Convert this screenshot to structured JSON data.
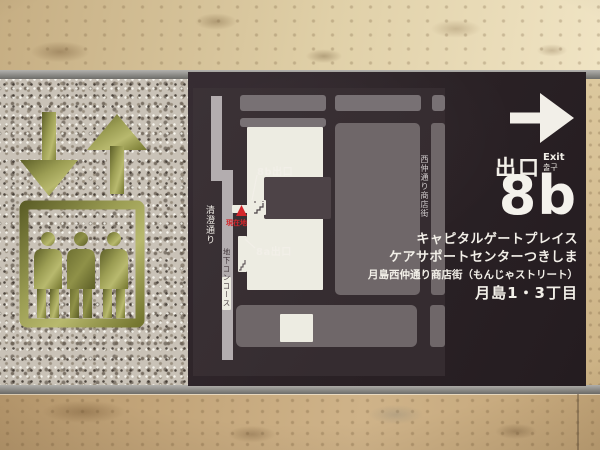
{
  "sign": {
    "exit_word_jp": "出口",
    "exit_word_en": "Exit",
    "exit_word_ko": "출구",
    "exit_number": "8b",
    "destinations": [
      "キャピタルゲートプレイス",
      "ケアサポートセンターつきしま",
      "月島西仲通り商店街（もんじゃストリート）",
      "月島1・3丁目"
    ]
  },
  "map": {
    "exit_8b_label": "8b出口",
    "exit_8a_label": "8a出口",
    "you_are_here_label": "現在地",
    "kiyosumi_street_label": "清澄通り",
    "underground_concourse_label": "地下コンコース",
    "nishinaka_street_label": "西仲通り商店街"
  },
  "icons": {
    "direction": "right-arrow-icon",
    "elevator": "elevator-people-icon with down-arrow-icon and up-arrow-icon",
    "exit_markers": "stairs-icon at 8a and 8b",
    "current_position": "you-are-here-triangle-icon"
  },
  "colors": {
    "sign_background": "#2b2226",
    "map_background": "#372e32",
    "city_block_gray": "#6f6769",
    "concourse_gray": "#b3adaf",
    "station_block_white": "#edece2",
    "text_white": "#f2efe8",
    "marker_red": "#d3262b",
    "brass_green": "#8f9148",
    "wall_tile_beige": "#e0d0a8",
    "granite_gray": "#c9c2b7"
  }
}
